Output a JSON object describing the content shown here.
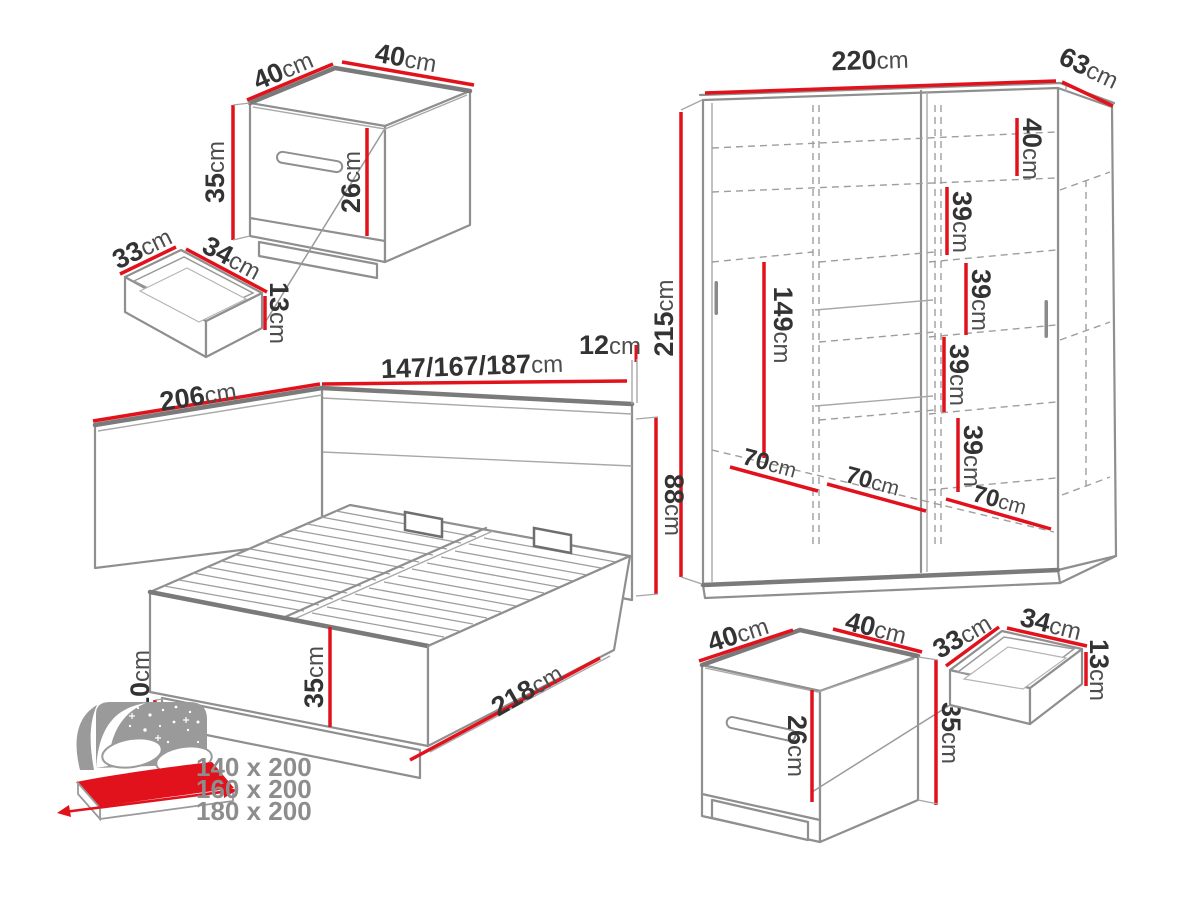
{
  "unit": "cm",
  "colors": {
    "dimension_red": "#e2121c",
    "outline_gray": "#8f8f8f",
    "dark_edge_gray": "#7a7a7a",
    "text_dark": "#333333",
    "legend_gray": "#8d8d8d"
  },
  "nightstand_top_left": {
    "top_depth": "40",
    "top_width": "40",
    "height": "35",
    "drawer_front_height": "26"
  },
  "drawer_top_left": {
    "depth": "33",
    "width": "34",
    "height": "13"
  },
  "bed": {
    "total_length": "206",
    "headboard_widths": "147/167/187",
    "headboard_top_depth": "12",
    "headboard_height": "88",
    "base_height": "10",
    "frame_height": "35",
    "side_length": "218"
  },
  "wardrobe": {
    "width": "220",
    "depth": "63",
    "height": "215",
    "hanging_height": "149",
    "shelf_gaps": [
      "40",
      "39",
      "39",
      "39",
      "39"
    ],
    "sections": [
      "70",
      "70",
      "70"
    ]
  },
  "nightstand_bottom_right": {
    "top_depth": "40",
    "top_width": "40",
    "height": "35",
    "drawer_front_height": "26"
  },
  "drawer_bottom_right": {
    "depth": "33",
    "width": "34",
    "height": "13"
  },
  "legend": {
    "bed_sizes": [
      "140 x 200",
      "160 x 200",
      "180 x 200"
    ]
  }
}
